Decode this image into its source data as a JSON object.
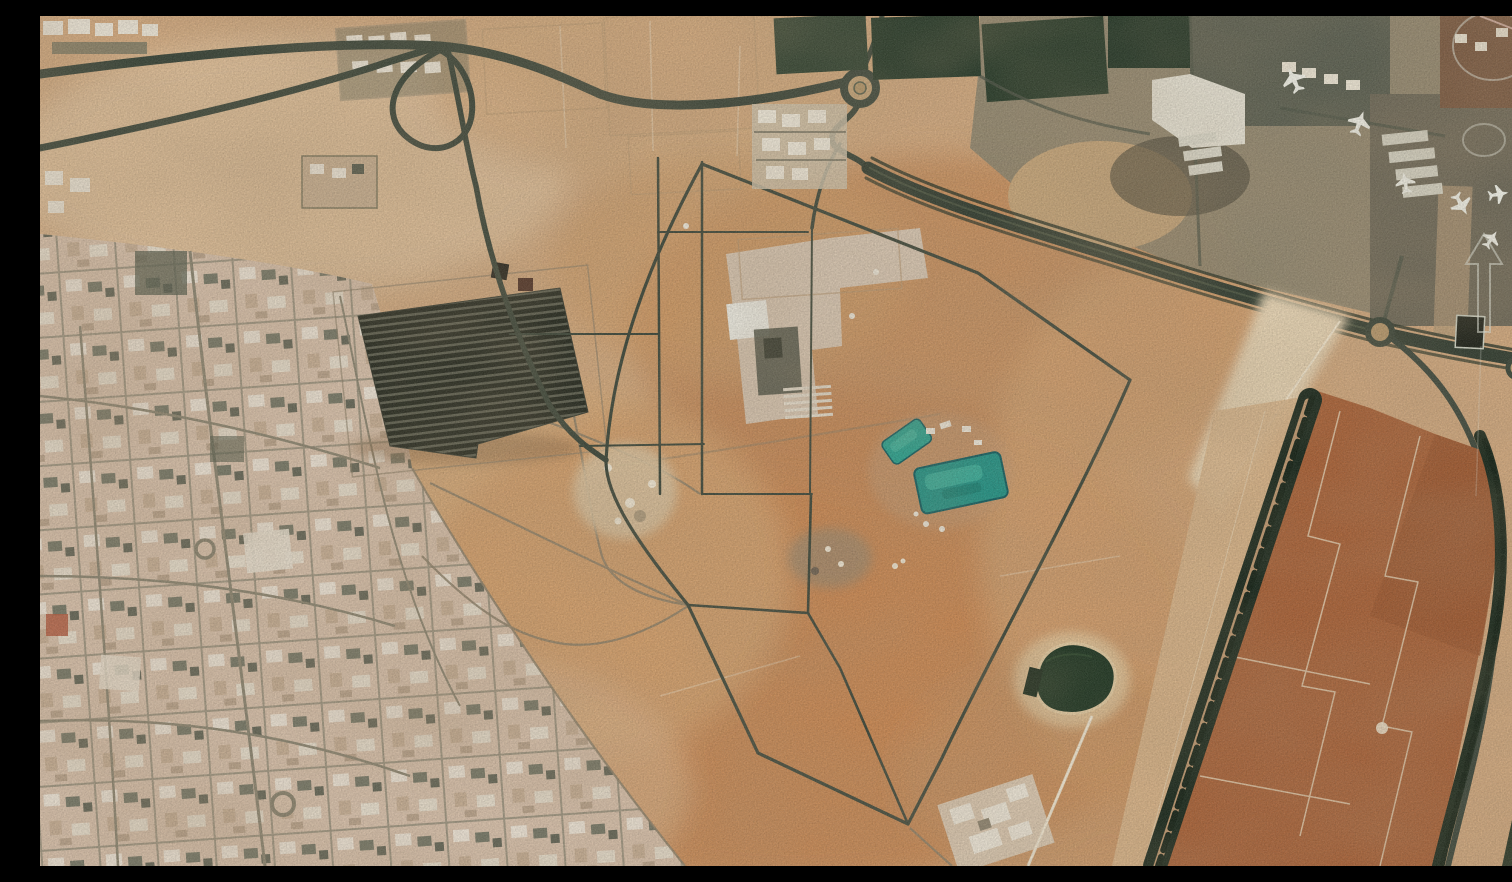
{
  "meta": {
    "type": "satellite-photograph",
    "title": "Satellite view — desert facility with airport apron, solar array and farmland",
    "description": "Aerial satellite photograph of an arid site. West: a dark highway interchange and a pale residential street grid with roundabouts. Center: a pentagonal perimeter road enclosing a compound with white buildings, a dark solar-panel array, two turquoise water reservoirs and a dark green pond. Northeast: airport apron with parked white aircraft, hangars and tree rows. East: a rectangular red-brown farm plot bordered by dark windbreak tree lines. Faint white analyst annotations (two ellipses and an upward arrow above a dark square building) overlay the right edge."
  },
  "palette": {
    "desert_base": "#d3ab81",
    "desert_orange": "#c5854f",
    "desert_pink": "#d9b896",
    "road_dark": "#3a463a",
    "dirt_road": "#8a7f69",
    "urban_base": "#d8c2ad",
    "building_white": "#f0ece2",
    "solar_dark": "#23281f",
    "pool_turquoise": "#27a391",
    "pond_dark": "#14301e",
    "farm_brown": "#a96137",
    "tree_dark": "#16271b",
    "tarmac_gray": "#6f7260",
    "annotation_white": "#dfe4da"
  },
  "features": [
    {
      "name": "highway-interchange",
      "note": "cloverleaf loop, northwest corner"
    },
    {
      "name": "residential-grid",
      "note": "pale housing blocks with two roundabouts, west side"
    },
    {
      "name": "solar-array",
      "note": "dark striped panel field"
    },
    {
      "name": "perimeter-road",
      "note": "pentagonal road around central facility"
    },
    {
      "name": "central-facility",
      "note": "white and dark buildings on light pad"
    },
    {
      "name": "reservoirs",
      "note": "two turquoise pools"
    },
    {
      "name": "pond",
      "note": "dark green water body with sand rim"
    },
    {
      "name": "airport-apron",
      "note": "seven parked white aircraft, northeast"
    },
    {
      "name": "farm-plot",
      "note": "red-brown fields with windbreak tree lines, east"
    },
    {
      "name": "roundabout-north",
      "note": "top center"
    },
    {
      "name": "roundabout-east",
      "note": "right edge"
    }
  ],
  "annotations": {
    "ellipse_large": "faint white ellipse, top right corner",
    "ellipse_small": "faint white ellipse on apron road",
    "arrow_up": "faint white upward arrow above dark square building"
  }
}
